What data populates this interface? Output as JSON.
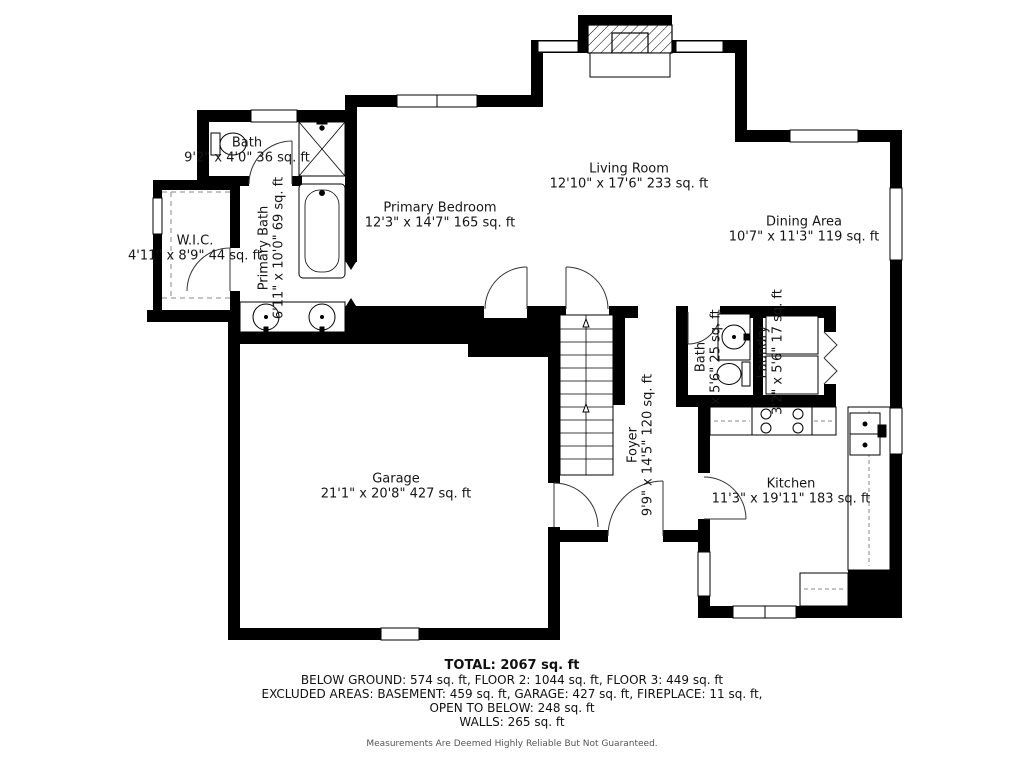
{
  "plan": {
    "rooms": {
      "bath_upper": {
        "name": "Bath",
        "dims": "9'2\" x 4'0\" 36 sq. ft"
      },
      "wic": {
        "name": "W.I.C.",
        "dims": "4'11\" x 8'9\" 44 sq. ft"
      },
      "primary_bath": {
        "name": "Primary Bath",
        "dims": "6'11\" x 10'0\" 69 sq. ft"
      },
      "primary_bedroom": {
        "name": "Primary Bedroom",
        "dims": "12'3\" x 14'7\" 165 sq. ft"
      },
      "living_room": {
        "name": "Living Room",
        "dims": "12'10\" x 17'6\" 233 sq. ft"
      },
      "dining_area": {
        "name": "Dining Area",
        "dims": "10'7\" x 11'3\" 119 sq. ft"
      },
      "garage": {
        "name": "Garage",
        "dims": "21'1\" x 20'8\" 427 sq. ft"
      },
      "foyer": {
        "name": "Foyer",
        "dims": "9'9\" x 14'5\" 120 sq. ft"
      },
      "bath_small": {
        "name": "Bath",
        "dims": "x 5'6\" 25 sq. ft"
      },
      "laundry": {
        "name": "Laundry",
        "dims": "3'2\"  x 5'6\" 17 sq. ft"
      },
      "kitchen": {
        "name": "Kitchen",
        "dims": "11'3\" x 19'11\" 183 sq. ft"
      }
    },
    "summary": {
      "total": "TOTAL: 2067 sq. ft",
      "line1": "BELOW GROUND: 574 sq. ft, FLOOR 2: 1044 sq. ft, FLOOR 3: 449 sq. ft",
      "line2": "EXCLUDED AREAS: BASEMENT: 459 sq. ft, GARAGE: 427 sq. ft, FIREPLACE: 11 sq. ft,",
      "line3": "OPEN TO BELOW: 248 sq. ft",
      "line4": "WALLS: 265 sq. ft"
    },
    "disclaimer": "Measurements Are Deemed Highly Reliable But Not Guaranteed.",
    "colors": {
      "wall": "#000000",
      "line": "#333333",
      "text": "#161616",
      "muted": "#555555"
    }
  }
}
